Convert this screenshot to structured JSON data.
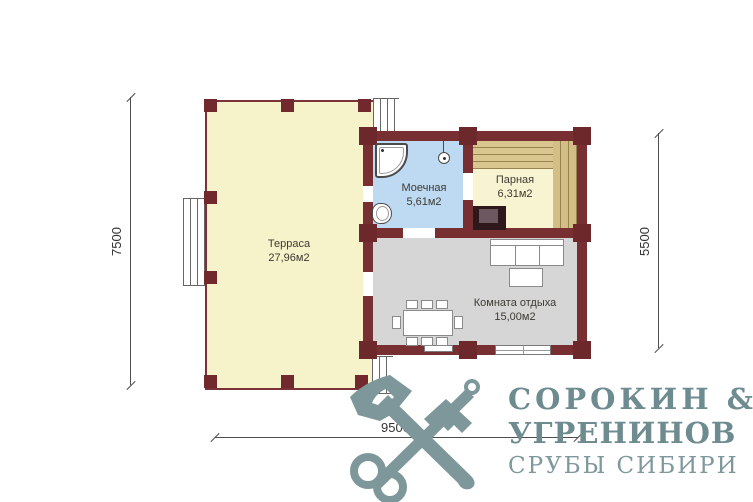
{
  "plan": {
    "rooms": [
      {
        "name": "Терраса",
        "area": "27,96м2"
      },
      {
        "name": "Моечная",
        "area": "5,61м2"
      },
      {
        "name": "Парная",
        "area": "6,31м2"
      },
      {
        "name": "Комната отдыха",
        "area": "15,00м2"
      }
    ],
    "dimensions": {
      "left": "7500",
      "right": "5500",
      "bottom": "9500"
    }
  },
  "logo": {
    "line1": "СОРОКИН &",
    "line2": "УГРЕНИНОВ",
    "line3": "СРУБЫ СИБИРИ"
  },
  "icons": {
    "shower": "shower-cabin-icon",
    "shower_head": "shower-head-icon",
    "sink": "sink-icon",
    "stove": "stove-icon",
    "sofa": "sofa-icon",
    "coffee_table": "coffee-table-icon",
    "dining_table": "dining-table-icon",
    "chair": "chair-icon",
    "steps": "steps-icon",
    "brand_mark": "axe-and-key-icon"
  },
  "colors": {
    "wall": "#772f32",
    "terrace_floor": "#f6f2c9",
    "washing_floor": "#bed9f2",
    "steam_floor": "#f8f4d2",
    "rest_floor": "#d6d6d6",
    "bench": "#d9c58e",
    "stove_outer": "#2e181b",
    "stove_inner": "#6d5862",
    "brand": "#7d979a"
  }
}
